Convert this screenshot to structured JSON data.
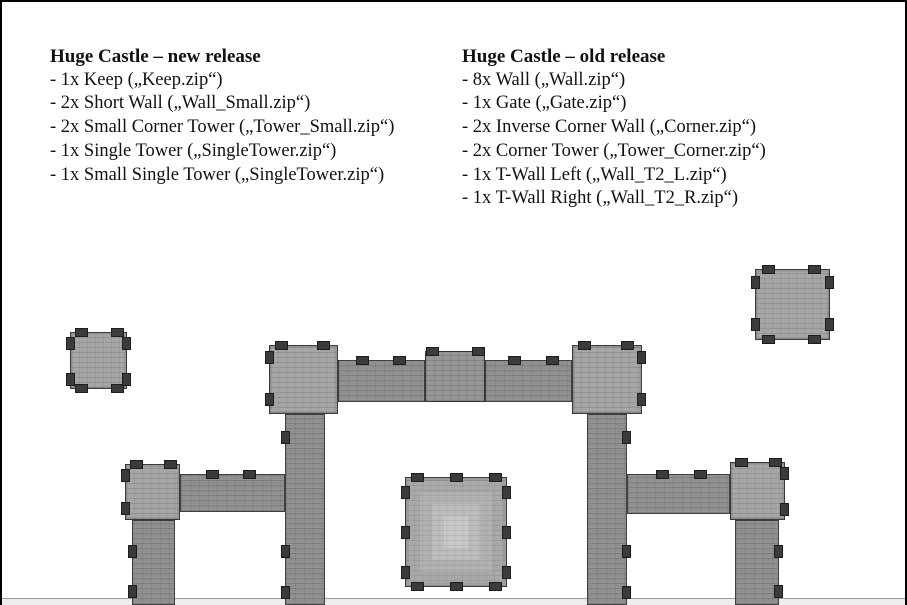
{
  "lists": [
    {
      "title": "Huge Castle – new release",
      "items": [
        "- 1x Keep („Keep.zip“)",
        "- 2x Short Wall („Wall_Small.zip“)",
        "- 2x Small Corner Tower („Tower_Small.zip“)",
        "- 1x Single Tower („SingleTower.zip“)",
        "- 1x Small Single Tower („SingleTower.zip“)"
      ]
    },
    {
      "title": "Huge Castle – old release",
      "items": [
        "- 8x Wall („Wall.zip“)",
        "- 1x Gate („Gate.zip“)",
        "- 2x Inverse Corner Wall („Corner.zip“)",
        "- 2x Corner Tower („Tower_Corner.zip“)",
        "- 1x T-Wall Left („Wall_T2_L.zip“)",
        "- 1x T-Wall Right („Wall_T2_R.zip“)"
      ]
    }
  ],
  "diagram": {
    "colors": {
      "wall": "#8f8f8f",
      "tower": "#a6a6a6",
      "keep": "#c8c8c8",
      "merlon": "#3b3b3b",
      "page_border": "#000000",
      "bottom_strip": "#ededed"
    },
    "pieces": [
      {
        "name": "gate-wall-left-segment",
        "type": "wall",
        "x": 336,
        "y": 358,
        "w": 87,
        "h": 42,
        "merlons": [
          {
            "side": "top",
            "pos": 17
          },
          {
            "side": "top",
            "pos": 54
          }
        ]
      },
      {
        "name": "gate-wall-right-segment",
        "type": "wall",
        "x": 483,
        "y": 358,
        "w": 87,
        "h": 42,
        "merlons": [
          {
            "side": "top",
            "pos": 22
          },
          {
            "side": "top",
            "pos": 60
          }
        ]
      },
      {
        "name": "gate-middle-section",
        "type": "gate",
        "x": 423,
        "y": 349,
        "w": 60,
        "h": 51,
        "merlons": [
          {
            "side": "top",
            "pos": 0
          },
          {
            "side": "top",
            "pos": 46
          }
        ]
      },
      {
        "name": "wall-vertical-inner-left",
        "type": "wall",
        "x": 283,
        "y": 412,
        "w": 40,
        "h": 191,
        "merlons": [
          {
            "side": "left",
            "pos": 16
          },
          {
            "side": "left",
            "pos": 130
          },
          {
            "side": "left",
            "pos": 171
          }
        ]
      },
      {
        "name": "wall-vertical-inner-right",
        "type": "wall",
        "x": 585,
        "y": 412,
        "w": 40,
        "h": 191,
        "merlons": [
          {
            "side": "right",
            "pos": 16
          },
          {
            "side": "right",
            "pos": 130
          },
          {
            "side": "right",
            "pos": 171
          }
        ]
      },
      {
        "name": "wall-horizontal-lower-left",
        "type": "wall",
        "x": 178,
        "y": 472,
        "w": 105,
        "h": 38,
        "merlons": [
          {
            "side": "top",
            "pos": 25
          },
          {
            "side": "top",
            "pos": 62
          }
        ]
      },
      {
        "name": "wall-horizontal-lower-right",
        "type": "wall",
        "x": 625,
        "y": 472,
        "w": 103,
        "h": 40,
        "merlons": [
          {
            "side": "top",
            "pos": 28
          },
          {
            "side": "top",
            "pos": 66
          }
        ]
      },
      {
        "name": "wall-vertical-far-left",
        "type": "wall",
        "x": 130,
        "y": 518,
        "w": 43,
        "h": 85,
        "merlons": [
          {
            "side": "left",
            "pos": 24
          },
          {
            "side": "left",
            "pos": 64
          }
        ]
      },
      {
        "name": "wall-vertical-far-right",
        "type": "wall",
        "x": 733,
        "y": 518,
        "w": 44,
        "h": 85,
        "merlons": [
          {
            "side": "right",
            "pos": 24
          },
          {
            "side": "right",
            "pos": 64
          }
        ]
      },
      {
        "name": "small-single-tower-top-left",
        "type": "tower",
        "x": 68,
        "y": 330,
        "w": 57,
        "h": 57,
        "merlons": [
          {
            "side": "top",
            "pos": 4
          },
          {
            "side": "top",
            "pos": 40
          },
          {
            "side": "bottom",
            "pos": 4
          },
          {
            "side": "bottom",
            "pos": 40
          },
          {
            "side": "left",
            "pos": 4
          },
          {
            "side": "left",
            "pos": 40
          },
          {
            "side": "right",
            "pos": 4
          },
          {
            "side": "right",
            "pos": 40
          }
        ]
      },
      {
        "name": "single-tower-top-right",
        "type": "tower",
        "x": 753,
        "y": 267,
        "w": 75,
        "h": 71,
        "merlons": [
          {
            "side": "top",
            "pos": 6
          },
          {
            "side": "top",
            "pos": 52
          },
          {
            "side": "bottom",
            "pos": 6
          },
          {
            "side": "bottom",
            "pos": 52
          },
          {
            "side": "left",
            "pos": 6
          },
          {
            "side": "left",
            "pos": 48
          },
          {
            "side": "right",
            "pos": 6
          },
          {
            "side": "right",
            "pos": 48
          }
        ]
      },
      {
        "name": "gate-corner-tower-left",
        "type": "tower",
        "x": 267,
        "y": 343,
        "w": 69,
        "h": 69,
        "merlons": [
          {
            "side": "top",
            "pos": 5
          },
          {
            "side": "top",
            "pos": 47
          },
          {
            "side": "left",
            "pos": 5
          },
          {
            "side": "left",
            "pos": 47
          }
        ]
      },
      {
        "name": "gate-corner-tower-right",
        "type": "tower",
        "x": 570,
        "y": 343,
        "w": 70,
        "h": 69,
        "merlons": [
          {
            "side": "top",
            "pos": 5
          },
          {
            "side": "top",
            "pos": 48
          },
          {
            "side": "right",
            "pos": 5
          },
          {
            "side": "right",
            "pos": 47
          }
        ]
      },
      {
        "name": "corner-tower-lower-left",
        "type": "tower",
        "x": 123,
        "y": 462,
        "w": 55,
        "h": 56,
        "merlons": [
          {
            "side": "top",
            "pos": 4
          },
          {
            "side": "top",
            "pos": 38
          },
          {
            "side": "left",
            "pos": 4
          },
          {
            "side": "left",
            "pos": 37
          }
        ]
      },
      {
        "name": "corner-tower-lower-right",
        "type": "tower",
        "x": 728,
        "y": 460,
        "w": 55,
        "h": 58,
        "merlons": [
          {
            "side": "top",
            "pos": 4
          },
          {
            "side": "top",
            "pos": 38
          },
          {
            "side": "right",
            "pos": 4
          },
          {
            "side": "right",
            "pos": 40
          }
        ]
      },
      {
        "name": "keep",
        "type": "keep",
        "x": 403,
        "y": 475,
        "w": 102,
        "h": 110,
        "merlons": [
          {
            "side": "top",
            "pos": 5
          },
          {
            "side": "top",
            "pos": 44
          },
          {
            "side": "top",
            "pos": 83
          },
          {
            "side": "bottom",
            "pos": 5
          },
          {
            "side": "bottom",
            "pos": 44
          },
          {
            "side": "bottom",
            "pos": 83
          },
          {
            "side": "left",
            "pos": 8
          },
          {
            "side": "left",
            "pos": 48
          },
          {
            "side": "left",
            "pos": 88
          },
          {
            "side": "right",
            "pos": 8
          },
          {
            "side": "right",
            "pos": 48
          },
          {
            "side": "right",
            "pos": 88
          }
        ]
      }
    ]
  }
}
